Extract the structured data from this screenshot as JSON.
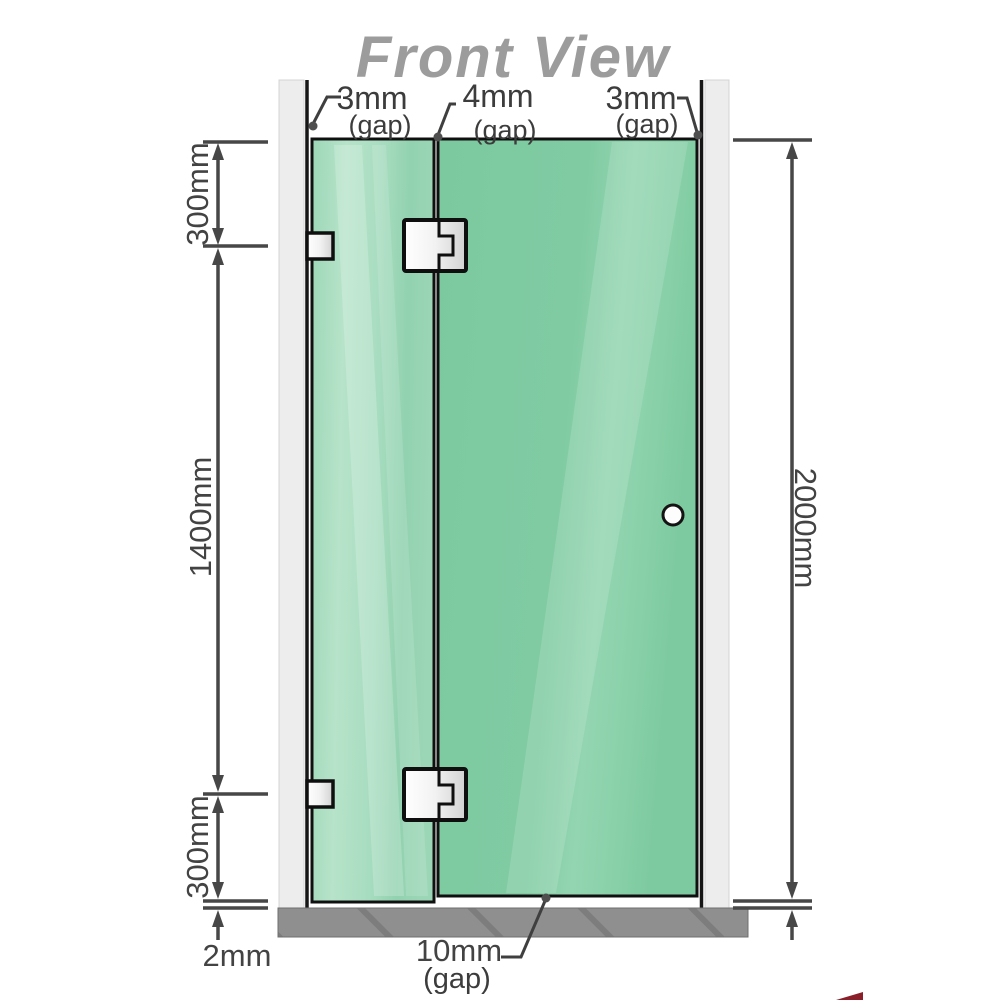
{
  "title": "Front View",
  "top_gaps": {
    "left": {
      "value": "3mm",
      "qualifier": "(gap)"
    },
    "middle": {
      "value": "4mm",
      "qualifier": "(gap)"
    },
    "right": {
      "value": "3mm",
      "qualifier": "(gap)"
    }
  },
  "bottom_gap": {
    "value": "10mm",
    "qualifier": "(gap)"
  },
  "side_dimensions": {
    "left_top": "300mm",
    "left_middle": "1400mm",
    "left_bottom": "300mm",
    "left_floor": "2mm",
    "right_total": "2000mm"
  },
  "colors": {
    "glass_green": "#82cba4",
    "glass_green_light": "#b4e2c8",
    "wall_gray": "#ededed",
    "floor_gray": "#8f8f8f",
    "dimension_gray": "#434343",
    "title_gray": "#9c9c9c",
    "hardware_outline": "#0f0f0f",
    "logo_red": "#8b1f29"
  }
}
